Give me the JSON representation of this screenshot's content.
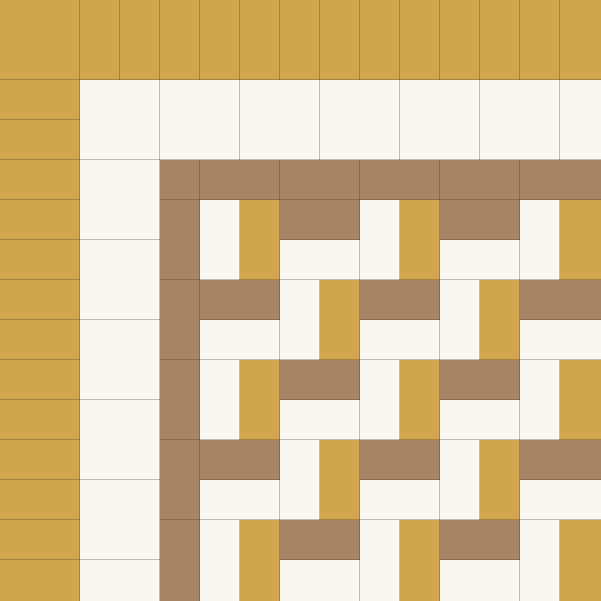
{
  "meta": {
    "description": "Basketweave quilt pattern: gold piano-key outer border, cream inner border, brown frame, and a gold, cream and brown basketweave center",
    "canvas_width": 601,
    "canvas_height": 601
  },
  "palette": {
    "gold": "#D1A64C",
    "cream": "#FAF7F0",
    "brown": "#A68565",
    "seam": "rgba(60,50,38,0.30)"
  },
  "pattern": {
    "outer_gold_border": {
      "color": "gold",
      "thickness": 80,
      "corner_size": 80,
      "strip_size": 40
    },
    "cream_border": {
      "color": "cream",
      "thickness": 80,
      "corner_size": 80,
      "strip_size": 80
    },
    "brown_frame": {
      "color": "brown",
      "thickness": 40,
      "corner_size": 40,
      "strip_size": 80
    },
    "weave": {
      "origin_x": 200,
      "origin_y": 200,
      "block_size": 80,
      "vertical_block": {
        "left": "cream",
        "right": "gold"
      },
      "horizontal_block": {
        "top": "brown",
        "bottom": "cream"
      },
      "rows": [
        "VHVHV",
        "HVHVH",
        "VHVHV",
        "HVHVH",
        "VHVHV"
      ]
    }
  }
}
